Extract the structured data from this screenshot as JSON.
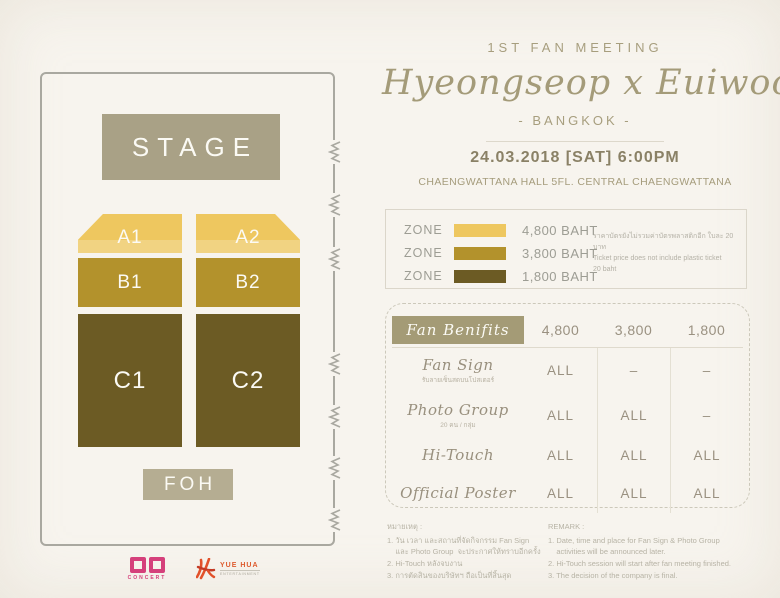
{
  "event": {
    "meeting_label": "1ST  FAN  MEETING",
    "title": "Hyeongseop x Euiwoong",
    "city": "- BANGKOK -",
    "datetime": "24.03.2018  [SAT]  6:00PM",
    "venue": "CHAENGWATTANA HALL  5FL. CENTRAL CHAENGWATTANA"
  },
  "seating": {
    "stage_label": "STAGE",
    "stage_color": "#a9a186",
    "foh_label": "FOH",
    "foh_color": "#b5ad92",
    "zones": [
      {
        "id": "A1",
        "color": "#eec75f"
      },
      {
        "id": "A2",
        "color": "#eec75f"
      },
      {
        "id": "B1",
        "color": "#b3922c"
      },
      {
        "id": "B2",
        "color": "#b3922c"
      },
      {
        "id": "C1",
        "color": "#6c5b24"
      },
      {
        "id": "C2",
        "color": "#6c5b24"
      }
    ]
  },
  "legend": {
    "rows": [
      {
        "zone_label": "ZONE",
        "color": "#eec75f",
        "price": "4,800 BAHT"
      },
      {
        "zone_label": "ZONE",
        "color": "#b3922c",
        "price": "3,800 BAHT"
      },
      {
        "zone_label": "ZONE",
        "color": "#6c5b24",
        "price": "1,800 BAHT"
      }
    ],
    "note_th": "ราคาบัตรยังไม่รวมค่าบัตรพลาสติกอีก ใบละ 20 บาท",
    "note_en_1": "Ticket price does not include plastic ticket",
    "note_en_2": "20 baht"
  },
  "benefits": {
    "title": "Fan Benifits",
    "col_heads": [
      "4,800",
      "3,800",
      "1,800"
    ],
    "rows": [
      {
        "name": "Fan Sign",
        "subtitle": "รับลายเซ็นสดบนโปสเตอร์",
        "values": [
          "ALL",
          "–",
          "–"
        ]
      },
      {
        "name": "Photo Group",
        "subtitle": "20 คน / กลุ่ม",
        "values": [
          "ALL",
          "ALL",
          "–"
        ]
      },
      {
        "name": "Hi-Touch",
        "subtitle": "",
        "values": [
          "ALL",
          "ALL",
          "ALL"
        ]
      },
      {
        "name": "Official Poster",
        "subtitle": "",
        "values": [
          "ALL",
          "ALL",
          "ALL"
        ]
      }
    ]
  },
  "remarks_th": {
    "title": "หมายเหตุ :",
    "items": [
      "1. วัน เวลา และสถานที่จัดกิจกรรม Fan Sign",
      "    และ Photo Group  จะประกาศให้ทราบอีกครั้ง",
      "2. Hi-Touch หลังจบงาน",
      "3. การตัดสินของบริษัทฯ ถือเป็นที่สิ้นสุด"
    ]
  },
  "remarks_en": {
    "title": "REMARK :",
    "items": [
      "1. Date, time and place for Fan Sign & Photo Group",
      "    activities will be announced later.",
      "2. Hi-Touch session will start after fan meeting finished.",
      "3. The decision of the company is final."
    ]
  },
  "footer": {
    "organizer_label": "CONCERT",
    "partner_name": "YUE HUA",
    "partner_sub": "ENTERTAINMENT"
  },
  "colors": {
    "background": "#f7f4ee",
    "accent_text": "#a49b79",
    "zone_a": "#eec75f",
    "zone_b": "#b3922c",
    "zone_c": "#6c5b24",
    "stage": "#a9a186",
    "dd_pink": "#d5407b",
    "yuehua_orange": "#de5b2e"
  }
}
